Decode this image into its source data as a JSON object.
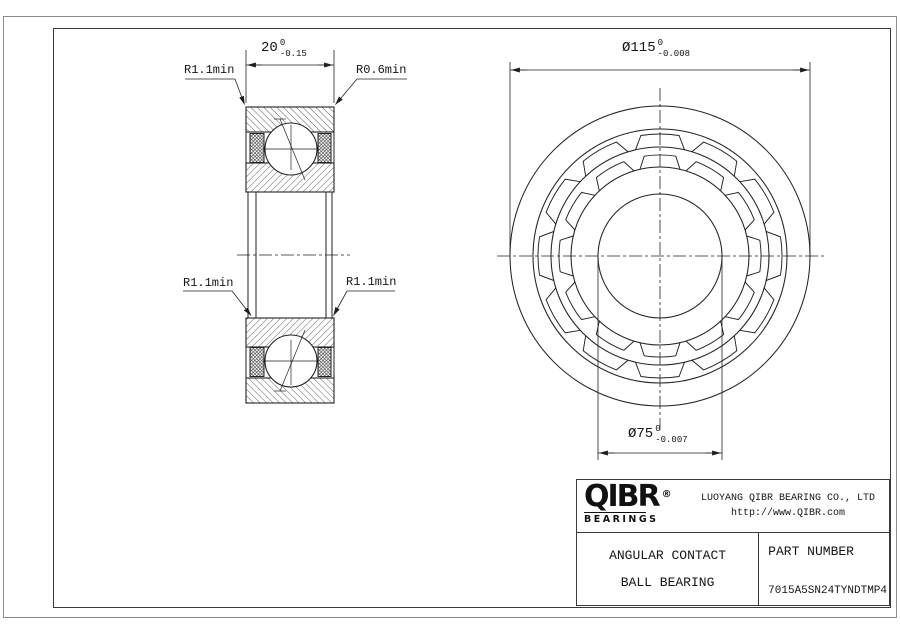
{
  "drawing": {
    "dimensions": {
      "width": {
        "value": "20",
        "tol_upper": "0",
        "tol_lower": "-0.15"
      },
      "outer_diameter": {
        "value": "Ø115",
        "tol_upper": "0",
        "tol_lower": "-0.008"
      },
      "bore_diameter": {
        "value": "Ø75",
        "tol_upper": "0",
        "tol_lower": "-0.007"
      }
    },
    "radius_labels": {
      "outer_top_left": "R1.1min",
      "outer_top_right": "R0.6min",
      "inner_left": "R1.1min",
      "inner_right": "R1.1min"
    }
  },
  "title_block": {
    "logo": {
      "text": "QIBR",
      "registered": "®",
      "subtext": "BEARINGS"
    },
    "company": "LUOYANG QIBR BEARING CO., LTD",
    "website": "http://www.QIBR.com",
    "product_name_line1": "ANGULAR CONTACT",
    "product_name_line2": "BALL BEARING",
    "part_number_label": "PART NUMBER",
    "part_number": "7015A5SN24TYNDTMP4"
  }
}
